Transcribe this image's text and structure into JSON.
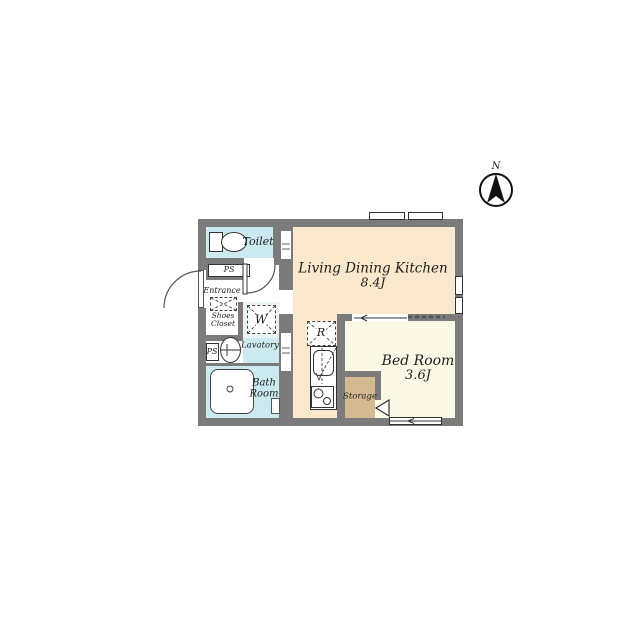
{
  "title": "apartment floor plan",
  "compass": {
    "north_label": "N"
  },
  "rooms": {
    "ldk": {
      "name": "Living Dining Kitchen",
      "size": "8.4J"
    },
    "bedroom": {
      "name": "Bed Room",
      "size": "3.6J"
    },
    "toilet": {
      "name": "Toilet"
    },
    "bath": {
      "line1": "Bath",
      "line2": "Room"
    },
    "lavatory": {
      "name": "Lavatory"
    },
    "entrance": {
      "name": "Entrance"
    },
    "shoes_closet": {
      "line1": "Shoes",
      "line2": "Closet"
    },
    "storage": {
      "name": "Storage"
    },
    "pipe_space_upper": "PS",
    "pipe_space_lower": "PS",
    "washer_space": "W",
    "fridge_space": "R"
  },
  "colors": {
    "wall": "#7b7b7b",
    "ldk_floor": "#f9e8cb",
    "bedroom_floor": "#fbf8e6",
    "wet_floor": "#cde9f0",
    "storage_floor": "#d3ba90",
    "washer_alcove_floor": "#eaf4f7",
    "background": "#ffffff",
    "line": "#333333"
  }
}
